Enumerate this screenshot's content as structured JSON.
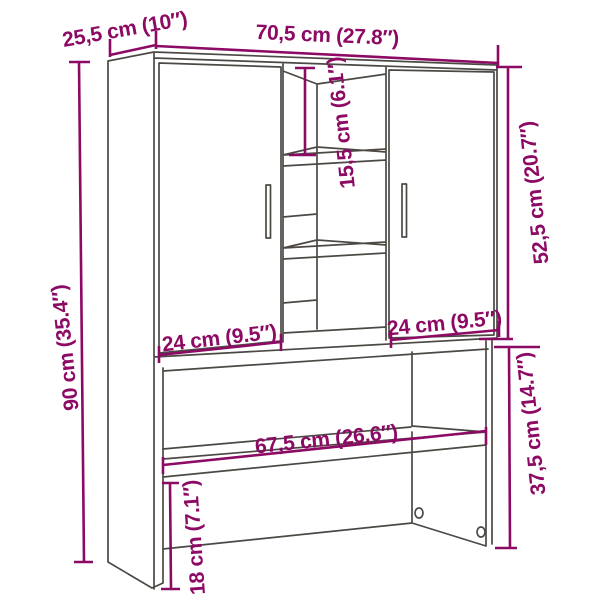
{
  "figure": {
    "dimension_color": "#8c0a64",
    "line_color": "#4c4945",
    "background_color": "#ffffff"
  },
  "dimensions": {
    "depth_top": "25,5 cm (10″)",
    "width_top": "70,5 cm (27.8″)",
    "middle_opening_height": "15,5 cm (6.1″)",
    "upper_section_height": "52,5 cm (20.7″)",
    "total_height": "90 cm (35.4″)",
    "left_door_width": "24 cm (9.5″)",
    "right_door_width": "24 cm (9.5″)",
    "shelf_width": "67,5 cm (26.6″)",
    "lower_section_height": "37,5 cm (14.7″)",
    "lower_side_panel_height": "18 cm (7.1″)"
  }
}
